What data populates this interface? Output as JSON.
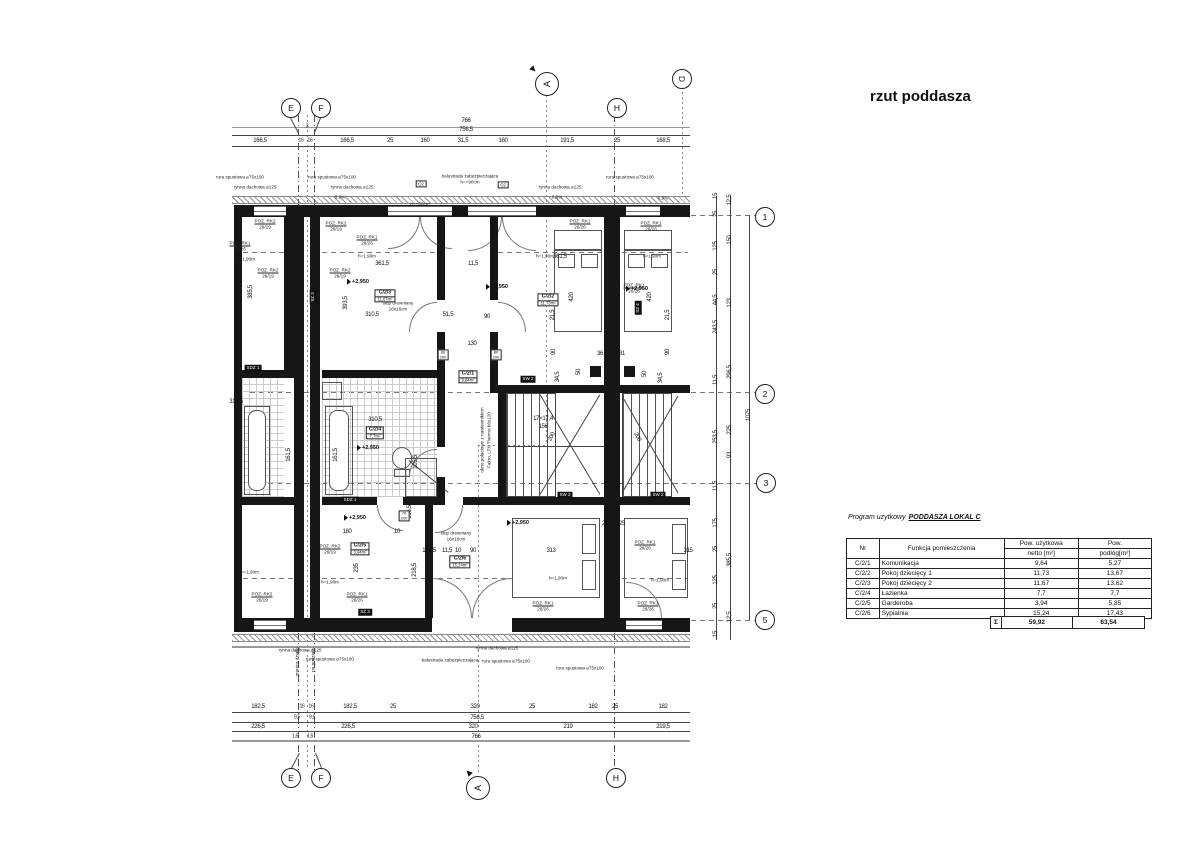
{
  "title": "rzut poddasza",
  "table": {
    "caption_prefix": "Program użytkowy",
    "caption_title": "PODDASZA  LOKAL C",
    "headers": {
      "nr": "Nr",
      "func": "Funkcja pomieszczenia",
      "net1": "Pow. użytkowa",
      "net2": "netto [m²]",
      "floor1": "Pow.",
      "floor2": "podłóg[m²]"
    },
    "rows": [
      [
        "C/2/1",
        "Komunikacja",
        "9,64",
        "5,27"
      ],
      [
        "C/2/2",
        "Pokój dziecięcy 1",
        "11,73",
        "13,67"
      ],
      [
        "C/2/3",
        "Pokój dziecięcy 2",
        "11,67",
        "13,62"
      ],
      [
        "C/2/4",
        "Łazienka",
        "7,7",
        "7,7"
      ],
      [
        "C/2/5",
        "Garderoba",
        "3,94",
        "5,85"
      ],
      [
        "C/2/6",
        "Sypialnia",
        "15,24",
        "17,43"
      ]
    ],
    "sum": {
      "sigma": "Σ",
      "net": "59,92",
      "floor": "63,54"
    }
  },
  "grid": {
    "bubbles": [
      {
        "t": "E",
        "x": 291,
        "y": 108
      },
      {
        "t": "F",
        "x": 321,
        "y": 108
      },
      {
        "t": "H",
        "x": 617,
        "y": 108
      },
      {
        "t": "E",
        "x": 291,
        "y": 778
      },
      {
        "t": "F",
        "x": 321,
        "y": 778
      },
      {
        "t": "H",
        "x": 616,
        "y": 778
      },
      {
        "t": "1",
        "x": 765,
        "y": 217
      },
      {
        "t": "2",
        "x": 765,
        "y": 394
      },
      {
        "t": "3",
        "x": 766,
        "y": 483
      },
      {
        "t": "5",
        "x": 765,
        "y": 620
      },
      {
        "t": "D",
        "x": 682,
        "y": 79,
        "rot": 1
      }
    ],
    "sections": [
      {
        "t": "A",
        "x": 547,
        "y": 84,
        "tx": 534,
        "ty": 70,
        "tr": -45
      },
      {
        "t": "A",
        "x": 478,
        "y": 788,
        "tx": 468,
        "ty": 772,
        "tr": 135
      }
    ]
  },
  "dims": {
    "rows": [
      {
        "y": 121,
        "items": [
          {
            "t": "766",
            "x": 466
          }
        ]
      },
      {
        "y": 130,
        "items": [
          {
            "t": "756,5",
            "x": 466
          }
        ]
      },
      {
        "y": 127,
        "items": [
          {
            "t": "3",
            "x": 307,
            "s": 1
          }
        ]
      },
      {
        "y": 141,
        "items": [
          {
            "t": "166,5",
            "x": 260
          },
          {
            "t": "16",
            "x": 301,
            "s": 1
          },
          {
            "t": "16",
            "x": 310,
            "s": 1
          },
          {
            "t": "166,5",
            "x": 347
          },
          {
            "t": "25",
            "x": 390
          },
          {
            "t": "160",
            "x": 425
          },
          {
            "t": "31,5",
            "x": 463
          },
          {
            "t": "160",
            "x": 503
          },
          {
            "t": "191,5",
            "x": 567
          },
          {
            "t": "25",
            "x": 617
          },
          {
            "t": "168,5",
            "x": 663
          }
        ]
      },
      {
        "y": 707,
        "items": [
          {
            "t": "182,5",
            "x": 258
          },
          {
            "t": "16",
            "x": 302,
            "s": 1
          },
          {
            "t": "16",
            "x": 311,
            "s": 1
          },
          {
            "t": "182,5",
            "x": 350
          },
          {
            "t": "25",
            "x": 393
          },
          {
            "t": "320",
            "x": 475
          },
          {
            "t": "25",
            "x": 532
          },
          {
            "t": "182",
            "x": 593
          },
          {
            "t": "25",
            "x": 615
          },
          {
            "t": "182",
            "x": 663
          }
        ]
      },
      {
        "y": 718,
        "items": [
          {
            "t": "9,5",
            "x": 297,
            "s": 1
          },
          {
            "t": "9,5",
            "x": 312,
            "s": 1
          },
          {
            "t": "756,5",
            "x": 477
          }
        ]
      },
      {
        "y": 727,
        "items": [
          {
            "t": "226,5",
            "x": 258
          },
          {
            "t": "226,5",
            "x": 348
          },
          {
            "t": "320",
            "x": 473
          },
          {
            "t": "219",
            "x": 568
          },
          {
            "t": "219,5",
            "x": 663
          }
        ]
      },
      {
        "y": 737,
        "items": [
          {
            "t": "1,5",
            "x": 295,
            "s": 1
          },
          {
            "t": "1,5",
            "x": 310,
            "s": 1
          },
          {
            "t": "766",
            "x": 476
          }
        ]
      }
    ],
    "right_cols": [
      {
        "x": 716,
        "items": [
          {
            "t": "15",
            "y": 196
          },
          {
            "t": "25",
            "y": 214
          },
          {
            "t": "125",
            "y": 246
          },
          {
            "t": "25",
            "y": 272
          },
          {
            "t": "44,5",
            "y": 300
          },
          {
            "t": "243,5",
            "y": 327
          },
          {
            "t": "11,5",
            "y": 380
          },
          {
            "t": "253,5",
            "y": 437
          },
          {
            "t": "11,5",
            "y": 486
          },
          {
            "t": "175",
            "y": 523
          },
          {
            "t": "25",
            "y": 549
          },
          {
            "t": "125",
            "y": 580
          },
          {
            "t": "25",
            "y": 606
          },
          {
            "t": "15",
            "y": 634
          }
        ]
      },
      {
        "x": 730,
        "items": [
          {
            "t": "12,5",
            "y": 200
          },
          {
            "t": "150",
            "y": 240
          },
          {
            "t": "123",
            "y": 303
          },
          {
            "t": "296,5",
            "y": 372
          },
          {
            "t": "225",
            "y": 430
          },
          {
            "t": "93",
            "y": 455
          },
          {
            "t": "385,5",
            "y": 560
          },
          {
            "t": "12,5",
            "y": 617
          }
        ]
      },
      {
        "x": 749,
        "items": [
          {
            "t": "1075",
            "y": 415
          }
        ]
      }
    ]
  },
  "plan": {
    "level_value": "+2,950",
    "levels": [
      {
        "x": 358,
        "y": 282
      },
      {
        "x": 497,
        "y": 287
      },
      {
        "x": 637,
        "y": 289
      },
      {
        "x": 368,
        "y": 448
      },
      {
        "x": 355,
        "y": 518
      },
      {
        "x": 518,
        "y": 523
      }
    ],
    "tags": [
      {
        "id": "C/2/3",
        "area": "11,67m²",
        "x": 385,
        "y": 296
      },
      {
        "id": "C/2/2",
        "area": "11,73m²",
        "x": 548,
        "y": 300
      },
      {
        "id": "C/2/1",
        "area": "9,64m²",
        "x": 468,
        "y": 377
      },
      {
        "id": "C/2/4",
        "area": "7,7m²",
        "x": 375,
        "y": 433
      },
      {
        "id": "C/2/5",
        "area": "3,94m²",
        "x": 360,
        "y": 549
      },
      {
        "id": "C/2/6",
        "area": "15,24m²",
        "x": 460,
        "y": 562
      }
    ],
    "chips": [
      {
        "t": "SZ 3",
        "x": 313,
        "y": 297,
        "v": 1
      },
      {
        "t": "SZ 4",
        "x": 638,
        "y": 308,
        "v": 1
      },
      {
        "t": "SDZ 1",
        "x": 253,
        "y": 368
      },
      {
        "t": "SDZ 1",
        "x": 350,
        "y": 500
      },
      {
        "t": "SZ 3",
        "x": 365,
        "y": 612
      },
      {
        "t": "SW 2",
        "x": 528,
        "y": 379
      },
      {
        "t": "SW 2",
        "x": 565,
        "y": 495
      },
      {
        "t": "SW 2",
        "x": 658,
        "y": 495
      }
    ],
    "door_tags": [
      {
        "w": "80",
        "h": "200",
        "x": 443,
        "y": 355
      },
      {
        "w": "80",
        "h": "200",
        "x": 496,
        "y": 355
      },
      {
        "w": "70",
        "h": "200",
        "x": 404,
        "y": 516
      }
    ],
    "win_tags": [
      {
        "t": "O2",
        "x": 421,
        "y": 184
      },
      {
        "t": "O2",
        "x": 503,
        "y": 185
      }
    ],
    "dims": [
      {
        "t": "361,5",
        "x": 382,
        "y": 264
      },
      {
        "t": "11,5",
        "x": 473,
        "y": 264
      },
      {
        "t": "361,5",
        "x": 560,
        "y": 257
      },
      {
        "t": "310,5",
        "x": 372,
        "y": 315
      },
      {
        "t": "51,5",
        "x": 448,
        "y": 315
      },
      {
        "t": "90",
        "x": 487,
        "y": 317
      },
      {
        "t": "130",
        "x": 472,
        "y": 344
      },
      {
        "t": "393,5",
        "x": 346,
        "y": 303,
        "r": 1
      },
      {
        "t": "385,5",
        "x": 251,
        "y": 292,
        "r": 1
      },
      {
        "t": "310,5",
        "x": 236,
        "y": 402
      },
      {
        "t": "420",
        "x": 572,
        "y": 297,
        "r": 1
      },
      {
        "t": "420",
        "x": 650,
        "y": 297,
        "r": 1
      },
      {
        "t": "21,5",
        "x": 553,
        "y": 315,
        "r": 1
      },
      {
        "t": "21,5",
        "x": 668,
        "y": 315,
        "r": 1
      },
      {
        "t": "90",
        "x": 554,
        "y": 352,
        "r": 1
      },
      {
        "t": "90",
        "x": 668,
        "y": 352,
        "r": 1
      },
      {
        "t": "36",
        "x": 600,
        "y": 354
      },
      {
        "t": "31",
        "x": 622,
        "y": 354
      },
      {
        "t": "34,5",
        "x": 558,
        "y": 377,
        "r": 1
      },
      {
        "t": "50",
        "x": 579,
        "y": 372,
        "r": 1
      },
      {
        "t": "50",
        "x": 645,
        "y": 374,
        "r": 1
      },
      {
        "t": "34,5",
        "x": 661,
        "y": 378,
        "r": 1
      },
      {
        "t": "17×17,4",
        "x": 543,
        "y": 419
      },
      {
        "t": "156",
        "x": 543,
        "y": 427
      },
      {
        "t": "200",
        "x": 552,
        "y": 437,
        "r": 2
      },
      {
        "t": "200",
        "x": 637,
        "y": 437,
        "r": 3
      },
      {
        "t": "161,5",
        "x": 289,
        "y": 455,
        "r": 1
      },
      {
        "t": "161,5",
        "x": 336,
        "y": 455,
        "r": 1
      },
      {
        "t": "105,5",
        "x": 416,
        "y": 462,
        "r": 1
      },
      {
        "t": "310,5",
        "x": 375,
        "y": 420
      },
      {
        "t": "180",
        "x": 347,
        "y": 532
      },
      {
        "t": "10",
        "x": 397,
        "y": 532
      },
      {
        "t": "235",
        "x": 357,
        "y": 568,
        "r": 1
      },
      {
        "t": "218,5",
        "x": 415,
        "y": 570,
        "r": 1
      },
      {
        "t": "106,5",
        "x": 410,
        "y": 512,
        "r": 1
      },
      {
        "t": "120,5",
        "x": 429,
        "y": 551
      },
      {
        "t": "11,5",
        "x": 447,
        "y": 551
      },
      {
        "t": "10",
        "x": 458,
        "y": 551
      },
      {
        "t": "90",
        "x": 473,
        "y": 551
      },
      {
        "t": "313",
        "x": 551,
        "y": 551
      },
      {
        "t": "315",
        "x": 688,
        "y": 551
      },
      {
        "t": "25",
        "x": 605,
        "y": 524
      },
      {
        "t": "25",
        "x": 622,
        "y": 524
      }
    ],
    "labels": [
      {
        "l1": "POZ. RK2",
        "l2": "26/19",
        "x": 265,
        "y": 224,
        "u": 1
      },
      {
        "l1": "POZ. RK1",
        "l2": "26/26",
        "x": 240,
        "y": 246,
        "u": 1
      },
      {
        "l1": "POZ. RK2",
        "l2": "26/19",
        "x": 336,
        "y": 226,
        "u": 1
      },
      {
        "l1": "POZ. RK1",
        "l2": "26/26",
        "x": 367,
        "y": 240,
        "u": 1
      },
      {
        "l1": "POZ. RK1",
        "l2": "26/26",
        "x": 580,
        "y": 224,
        "u": 1
      },
      {
        "l1": "POZ. RK1",
        "l2": "26/26",
        "x": 651,
        "y": 226,
        "u": 1
      },
      {
        "l1": "POZ. RK1",
        "l2": "26/26",
        "x": 634,
        "y": 288,
        "u": 1
      },
      {
        "l1": "POZ. RK2",
        "l2": "26/19",
        "x": 268,
        "y": 273,
        "u": 1
      },
      {
        "l1": "POZ. RK2",
        "l2": "26/19",
        "x": 340,
        "y": 273,
        "u": 1
      },
      {
        "l1": "h=1,90m",
        "x": 246,
        "y": 259
      },
      {
        "l1": "h=1,90m",
        "x": 367,
        "y": 256
      },
      {
        "l1": "h=1,90m",
        "x": 545,
        "y": 256
      },
      {
        "l1": "h=1,90m",
        "x": 652,
        "y": 256
      },
      {
        "l1": "h=1,90m",
        "x": 250,
        "y": 572
      },
      {
        "l1": "h=1,90m",
        "x": 330,
        "y": 582
      },
      {
        "l1": "h=1,90m",
        "x": 558,
        "y": 578
      },
      {
        "l1": "h=1,90m",
        "x": 660,
        "y": 580
      },
      {
        "l1": "POZ. RK2",
        "l2": "26/19",
        "x": 330,
        "y": 549,
        "u": 1
      },
      {
        "l1": "POZ. RK1",
        "l2": "26/26",
        "x": 357,
        "y": 597,
        "u": 1
      },
      {
        "l1": "POZ. RK2",
        "l2": "26/19",
        "x": 262,
        "y": 597,
        "u": 1
      },
      {
        "l1": "POZ. RK1",
        "l2": "26/26",
        "x": 543,
        "y": 606,
        "u": 1
      },
      {
        "l1": "POZ. RK1",
        "l2": "26/26",
        "x": 648,
        "y": 606,
        "u": 1
      },
      {
        "l1": "POZ. RK1",
        "l2": "26/26",
        "x": 645,
        "y": 545,
        "u": 1
      },
      {
        "l1": "słup drewniany",
        "l2": "16x16cm",
        "x": 398,
        "y": 306
      },
      {
        "l1": "słup drewniany",
        "l2": "16x16cm",
        "x": 456,
        "y": 536
      },
      {
        "l1": "rynna dachowa ⌀125",
        "x": 255,
        "y": 187
      },
      {
        "l1": "rynna dachowa ⌀125",
        "x": 352,
        "y": 187
      },
      {
        "l1": "rynna dachowa ⌀125",
        "x": 560,
        "y": 187
      },
      {
        "l1": "rura spustowa ⌀75x100",
        "x": 240,
        "y": 177
      },
      {
        "l1": "rura spustowa ⌀75x100",
        "x": 332,
        "y": 177
      },
      {
        "l1": "rura spustowa ⌀75x100",
        "x": 630,
        "y": 177
      },
      {
        "l1": "rynna dachowa ⌀125",
        "x": 300,
        "y": 650
      },
      {
        "l1": "rynna dachowa ⌀125",
        "x": 497,
        "y": 648
      },
      {
        "l1": "rura spustowa ⌀75x100",
        "x": 330,
        "y": 659
      },
      {
        "l1": "rura spustowa ⌀75x100",
        "x": 506,
        "y": 661
      },
      {
        "l1": "rura spustowa ⌀75x100",
        "x": 580,
        "y": 668
      },
      {
        "l1": "balustrada zabezpieczająca",
        "l2": "h=+90cm",
        "x": 470,
        "y": 179
      },
      {
        "l1": "balustrada zabezpieczająca",
        "x": 450,
        "y": 660
      },
      {
        "l1": "granica działki",
        "x": 297,
        "y": 662,
        "r": 1
      },
      {
        "l1": "po podziale",
        "x": 313,
        "y": 660,
        "r": 1
      },
      {
        "l1": "okno połaciowe z nawiewnikiem",
        "x": 482,
        "y": 440,
        "r": 1
      },
      {
        "l1": "Fakro, LTK Thermo 66x120",
        "x": 489,
        "y": 440,
        "r": 1
      },
      {
        "l1": "0,9%",
        "x": 340,
        "y": 197
      },
      {
        "l1": "0,9%",
        "x": 557,
        "y": 197
      },
      {
        "l1": "0,9%",
        "x": 663,
        "y": 198
      },
      {
        "l1": "h=+90cm",
        "x": 420,
        "y": 204
      }
    ]
  }
}
